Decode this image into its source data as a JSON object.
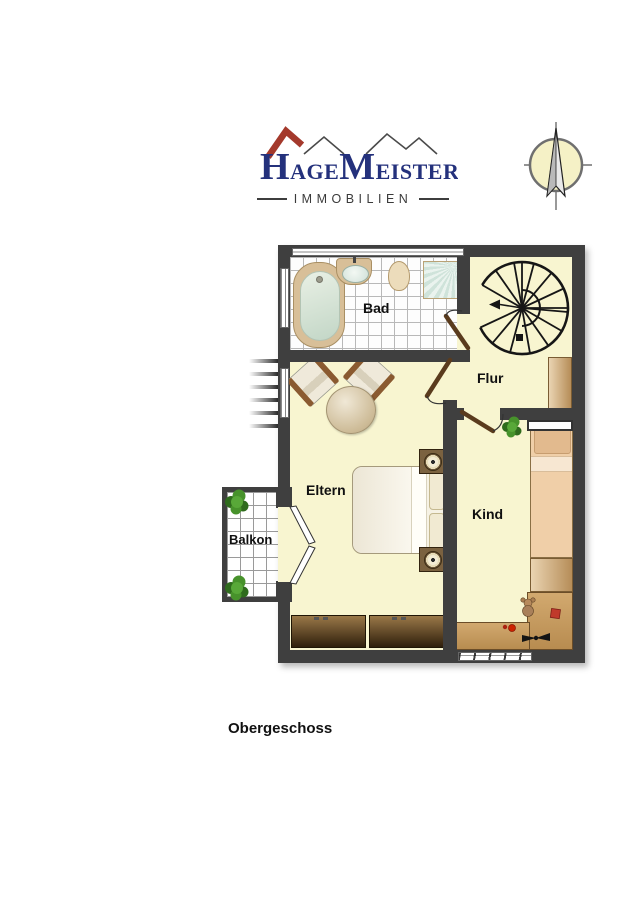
{
  "logo": {
    "h": "H",
    "age": "AGE",
    "m": "M",
    "eister": "EISTER",
    "subtitle": "IMMOBILIEN",
    "brand_navy": "#24317c",
    "roof_red": "#a4392c"
  },
  "compass": {
    "icon": "north-arrow"
  },
  "plan": {
    "caption": "Obergeschoss",
    "rooms": {
      "bad": {
        "label": "Bad"
      },
      "flur": {
        "label": "Flur"
      },
      "eltern": {
        "label": "Eltern"
      },
      "kind": {
        "label": "Kind"
      },
      "balkon": {
        "label": "Balkon"
      }
    },
    "colors": {
      "wall": "#3f3f3f",
      "floor": "#f8f5d0",
      "tile": "#ffffff",
      "door_wood": "#5a3b1d",
      "plant_green": "#47922b",
      "furniture_wood": "#c79f66",
      "toy_red": "#c0392b"
    }
  }
}
